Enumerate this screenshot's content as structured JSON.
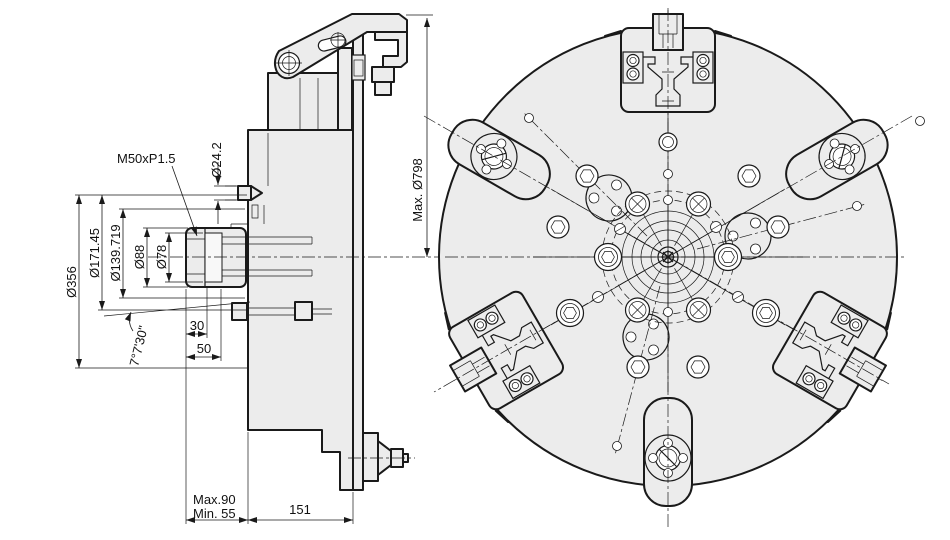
{
  "title": "Power chuck technical drawing",
  "side_view": {
    "dimensions": {
      "thread_label": "M50xP1.5",
      "pilot_dia": "Ø24.2",
      "body_dia": "Ø356",
      "flange_dia": "Ø171.45",
      "bolt_circle_dia": "Ø139.719",
      "bore_dia_1": "Ø88",
      "bore_dia_2": "Ø78",
      "depth_30": "30",
      "depth_50": "50",
      "taper_angle": "7°7'30\"",
      "stroke_max": "Max.90",
      "stroke_min": "Min. 55",
      "body_width": "151"
    }
  },
  "front_view": {
    "dimensions": {
      "max_swing_dia": "Max. Ø798"
    }
  },
  "colors": {
    "line": "#1a1a1a",
    "body_fill": "#ececec",
    "background": "#ffffff"
  }
}
